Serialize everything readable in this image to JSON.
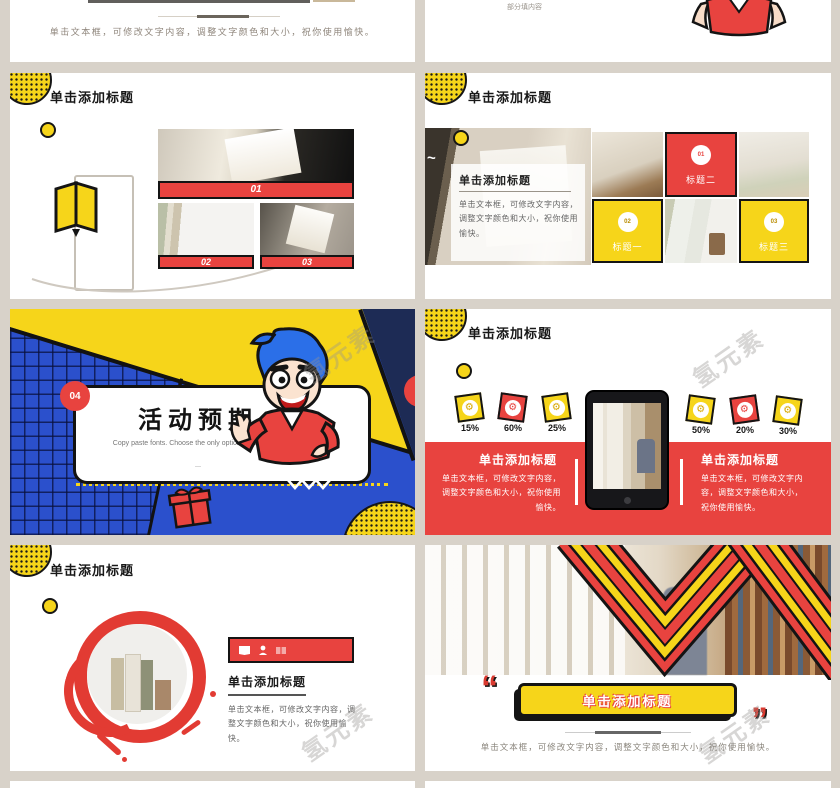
{
  "page": {
    "watermark": "氢元素"
  },
  "slide1_left": {
    "caption": "单击文本框，可修改文字内容，调整文字颜色和大小，祝你使用愉快。"
  },
  "slide1_right": {
    "note": "部分填内容"
  },
  "slide2_left": {
    "title": "单击添加标题",
    "bar1": "01",
    "bar2": "02",
    "bar3": "03"
  },
  "slide2_right": {
    "title": "单击添加标题",
    "panel_heading": "单击添加标题",
    "panel_body": "单击文本框，可修改文字内容，调整文字颜色和大小，祝你使用愉快。",
    "tiles": [
      {
        "num": "01",
        "label": "标题二"
      },
      {
        "num": "02",
        "label": "标题一"
      },
      {
        "num": "03",
        "label": "标题三"
      }
    ]
  },
  "slide3_left": {
    "number": "04",
    "title": "活动预期",
    "subtitle": "Copy paste fonts. Choose the only option to retain text.",
    "dash": "—"
  },
  "slide3_right": {
    "title": "单击添加标题",
    "badges": [
      {
        "value": "15%"
      },
      {
        "value": "60%"
      },
      {
        "value": "25%"
      },
      {
        "value": "50%"
      },
      {
        "value": "20%"
      },
      {
        "value": "30%"
      }
    ],
    "left_panel": {
      "heading": "单击添加标题",
      "body": "单击文本框，可修改文字内容，调整文字颜色和大小，祝你使用愉快。"
    },
    "right_panel": {
      "heading": "单击添加标题",
      "body": "单击文本框，可修改文字内容，调整文字颜色和大小，祝你使用愉快。"
    }
  },
  "slide4_left": {
    "title": "单击添加标题",
    "heading": "单击添加标题",
    "body": "单击文本框，可修改文字内容，调整文字颜色和大小，祝你使用愉快。"
  },
  "slide4_right": {
    "open_quote": "“",
    "banner": "单击添加标题",
    "close_quote": "”",
    "caption": "单击文本框，可修改文字内容，调整文字颜色和大小，祝你使用愉快。"
  },
  "colors": {
    "red": "#e8433f",
    "yellow": "#f6d51a",
    "blue": "#2b50cc",
    "navy": "#1d2b55",
    "page_bg": "#d8d2c9"
  }
}
